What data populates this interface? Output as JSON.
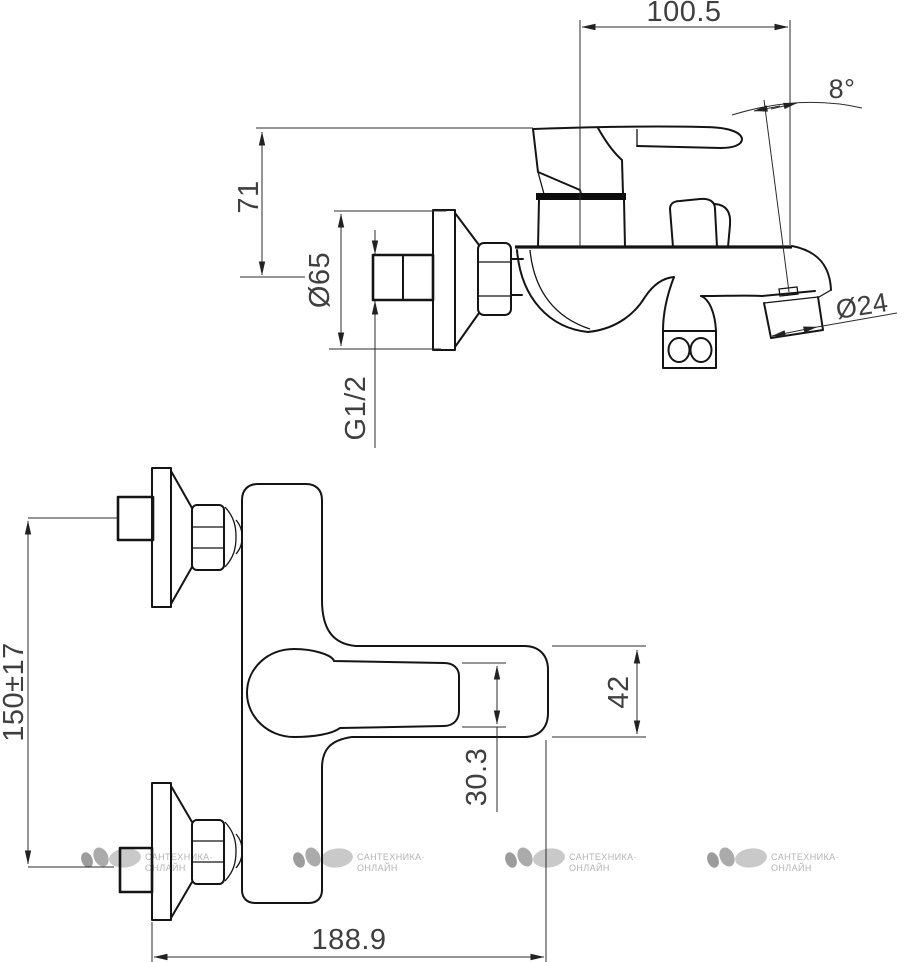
{
  "drawing_kind": "faucet-technical-drawing",
  "colors": {
    "background": "#ffffff",
    "line": "#141414",
    "dimension_text": "#3f3f3f",
    "watermark": "#b3b3b3"
  },
  "dims": {
    "spout_reach": "100.5",
    "spout_angle": "8°",
    "handle_height": "71",
    "escutcheon_diameter": "Ø65",
    "connection_thread": "G1/2",
    "aerator_diameter": "Ø24",
    "inlet_spacing": "150±17",
    "spout_body_height": "42",
    "handle_end_width": "30.3",
    "overall_length": "188.9"
  },
  "watermark": {
    "line1": "САНТЕХНИКА·",
    "line2": "ОНЛАЙН",
    "logo_icon": "three-pebble-ellipses",
    "count": 4
  }
}
